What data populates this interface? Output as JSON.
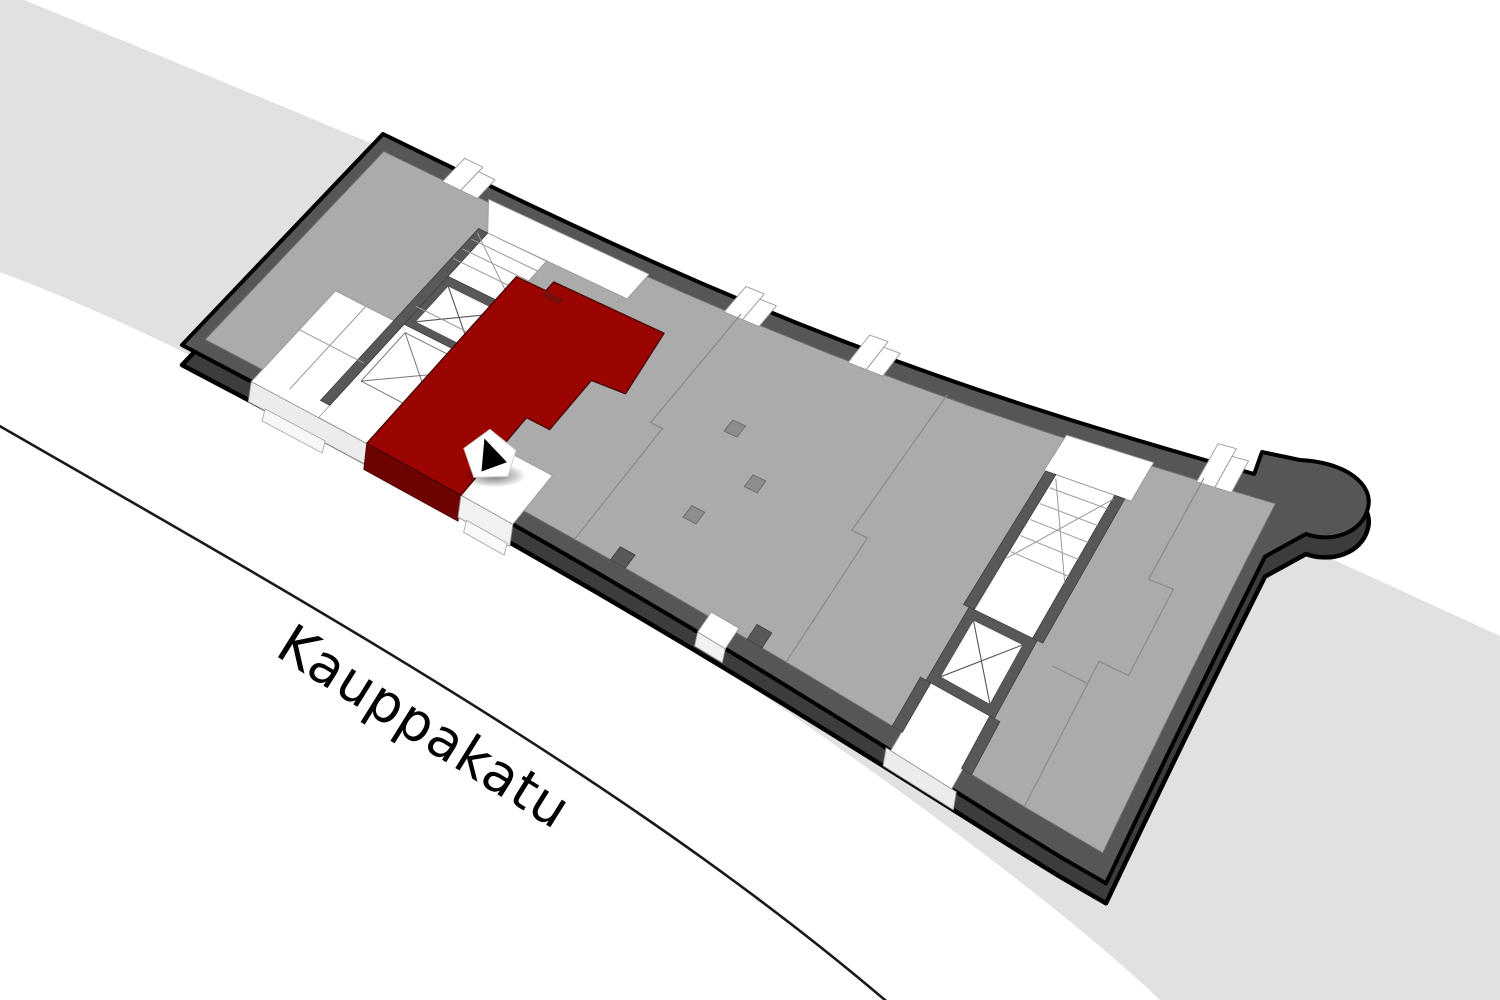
{
  "page": {
    "width": 1500,
    "height": 1000,
    "background": "#ffffff"
  },
  "street": {
    "label": "Kauppakatu",
    "angle_deg": 32,
    "band_color": "#e1e1e1",
    "curb_color": "#1a1a1a",
    "band_path": "M 24,0 C 500,195 1000,405 1500,636 L 1500,1000 L 1160,1000 C 1005,850 420,430 0,272 L 0,0 Z",
    "curb_path": "M -4,424 C 320,610 640,790 892,1006"
  },
  "marker": {
    "u": 0.3,
    "v": 0.84,
    "base_color": "#ffffff",
    "arrow_color": "#000000"
  },
  "building": {
    "corners": {
      "N": [
        383,
        134
      ],
      "E": [
        1300,
        487
      ],
      "S": [
        1045,
        848
      ],
      "W": [
        121,
        313
      ]
    },
    "shear": 0.066,
    "sag_top": 30,
    "sag_front": -16,
    "base_drop": 20,
    "colors": {
      "wall_top": "#565656",
      "wall_side": "#3c3c3c",
      "outline": "#000000",
      "floor": "#ababab",
      "floor_line": "#6e6e6e",
      "white": "#ffffff",
      "white_edge": "#9a9a9a",
      "divider": "#8a8a8a",
      "shaft": "#585858",
      "column": "#8d8d8d",
      "column_edge": "#6e6e6e",
      "unit_red": "#9a0502",
      "unit_red_front": "#6d0401",
      "unit_red_dark": "#7c0e0a",
      "unit_red_edge": "#4d0300"
    },
    "bulge": {
      "after_u": 0.95,
      "pts_line": [
        [
          1262,
          452
        ],
        [
          1300,
          460
        ]
      ],
      "bez": [
        [
          1345,
          462
        ],
        [
          1374,
          484
        ],
        [
          1368,
          508
        ],
        [
          1362,
          534
        ],
        [
          1330,
          543
        ],
        [
          1306,
          534
        ]
      ],
      "resume_v": 0.18
    },
    "floor_inset": {
      "u0": 0.013,
      "u1": 0.985,
      "v0": 0.055,
      "v1": 0.945
    },
    "white_areas": [
      {
        "id": "sw-rooms-block",
        "pts": [
          [
            0.075,
            0.58
          ],
          [
            0.145,
            0.58
          ],
          [
            0.145,
            0.42
          ],
          [
            0.215,
            0.42
          ],
          [
            0.215,
            1.0
          ],
          [
            0.075,
            1.0
          ]
        ]
      },
      {
        "id": "corridor-west-top",
        "pts": [
          [
            0.125,
            0.045
          ],
          [
            0.3,
            0.045
          ],
          [
            0.3,
            0.155
          ],
          [
            0.148,
            0.155
          ]
        ]
      },
      {
        "id": "corridor-west",
        "pts": [
          [
            0.148,
            0.155
          ],
          [
            0.212,
            0.155
          ],
          [
            0.212,
            1.0
          ],
          [
            0.148,
            1.0
          ]
        ]
      },
      {
        "id": "corridor-east-top",
        "pts": [
          [
            0.755,
            0.045
          ],
          [
            0.85,
            0.045
          ],
          [
            0.85,
            0.16
          ],
          [
            0.755,
            0.16
          ]
        ]
      },
      {
        "id": "corridor-east",
        "pts": [
          [
            0.767,
            0.16
          ],
          [
            0.833,
            0.16
          ],
          [
            0.833,
            1.0
          ],
          [
            0.767,
            1.0
          ]
        ]
      },
      {
        "id": "entrance-landing",
        "pts": [
          [
            0.302,
            0.8
          ],
          [
            0.358,
            0.8
          ],
          [
            0.358,
            1.0
          ],
          [
            0.302,
            1.0
          ]
        ]
      },
      {
        "id": "front-door-mid",
        "pts": [
          [
            0.558,
            0.93
          ],
          [
            0.588,
            0.93
          ],
          [
            0.588,
            1.0
          ],
          [
            0.558,
            1.0
          ]
        ]
      }
    ],
    "north_tabs": [
      0.078,
      0.385,
      0.52,
      0.9
    ],
    "shaft_walls": [
      {
        "id": "elevator-west-shaft",
        "pts": [
          [
            0.143,
            0.355
          ],
          [
            0.227,
            0.355
          ],
          [
            0.227,
            0.575
          ],
          [
            0.143,
            0.575
          ]
        ]
      },
      {
        "id": "corridor-west-wall",
        "pts": [
          [
            0.138,
            0.155
          ],
          [
            0.148,
            0.155
          ],
          [
            0.148,
            0.945
          ],
          [
            0.138,
            0.945
          ]
        ]
      },
      {
        "id": "corridor-east-wall-a",
        "pts": [
          [
            0.757,
            0.16
          ],
          [
            0.768,
            0.16
          ],
          [
            0.768,
            0.58
          ],
          [
            0.757,
            0.58
          ]
        ]
      },
      {
        "id": "corridor-east-wall-b",
        "pts": [
          [
            0.832,
            0.16
          ],
          [
            0.843,
            0.16
          ],
          [
            0.843,
            0.58
          ],
          [
            0.832,
            0.58
          ]
        ]
      },
      {
        "id": "corridor-east-wall-c",
        "pts": [
          [
            0.757,
            0.8
          ],
          [
            0.768,
            0.8
          ],
          [
            0.768,
            0.945
          ],
          [
            0.757,
            0.945
          ]
        ]
      },
      {
        "id": "corridor-east-wall-d",
        "pts": [
          [
            0.832,
            0.8
          ],
          [
            0.843,
            0.8
          ],
          [
            0.843,
            0.945
          ],
          [
            0.832,
            0.945
          ]
        ]
      },
      {
        "id": "elevator-east-shaft",
        "pts": [
          [
            0.763,
            0.58
          ],
          [
            0.837,
            0.58
          ],
          [
            0.837,
            0.8
          ],
          [
            0.763,
            0.8
          ]
        ]
      },
      {
        "id": "front-wall-stub-a",
        "pts": [
          [
            0.452,
            0.895
          ],
          [
            0.468,
            0.895
          ],
          [
            0.468,
            0.945
          ],
          [
            0.452,
            0.945
          ]
        ]
      },
      {
        "id": "front-wall-stub-b",
        "pts": [
          [
            0.6,
            0.895
          ],
          [
            0.616,
            0.895
          ],
          [
            0.616,
            0.945
          ],
          [
            0.6,
            0.945
          ]
        ]
      }
    ],
    "elevators": [
      {
        "id": "elevator-west",
        "pts": [
          [
            0.155,
            0.385
          ],
          [
            0.215,
            0.385
          ],
          [
            0.215,
            0.55
          ],
          [
            0.155,
            0.55
          ]
        ]
      },
      {
        "id": "elevator-east",
        "pts": [
          [
            0.773,
            0.605
          ],
          [
            0.827,
            0.605
          ],
          [
            0.827,
            0.775
          ],
          [
            0.773,
            0.775
          ]
        ]
      }
    ],
    "stair_boxes": [
      {
        "id": "stairs-sw-box",
        "pts": [
          [
            0.155,
            0.6
          ],
          [
            0.235,
            0.6
          ],
          [
            0.235,
            0.82
          ],
          [
            0.155,
            0.82
          ]
        ],
        "cross": true
      }
    ],
    "stair_lines": [
      {
        "id": "stairs-west-treads",
        "lines": [
          [
            [
              0.14,
              0.2
            ],
            [
              0.212,
              0.2
            ]
          ],
          [
            [
              0.14,
              0.245
            ],
            [
              0.212,
              0.245
            ]
          ],
          [
            [
              0.14,
              0.29
            ],
            [
              0.212,
              0.29
            ]
          ],
          [
            [
              0.14,
              0.17
            ],
            [
              0.212,
              0.335
            ]
          ]
        ]
      },
      {
        "id": "stairs-sw-treads",
        "lines": [
          [
            [
              0.235,
              0.64
            ],
            [
              0.26,
              0.64
            ]
          ],
          [
            [
              0.235,
              0.68
            ],
            [
              0.26,
              0.68
            ]
          ],
          [
            [
              0.235,
              0.72
            ],
            [
              0.26,
              0.72
            ]
          ],
          [
            [
              0.235,
              0.76
            ],
            [
              0.26,
              0.76
            ]
          ],
          [
            [
              0.235,
              0.8
            ],
            [
              0.26,
              0.8
            ]
          ]
        ]
      },
      {
        "id": "sw-room-lines",
        "lines": [
          [
            [
              0.108,
              0.58
            ],
            [
              0.108,
              0.96
            ]
          ],
          [
            [
              0.075,
              0.76
            ],
            [
              0.145,
              0.76
            ]
          ],
          [
            [
              0.145,
              0.5
            ],
            [
              0.215,
              0.5
            ]
          ]
        ]
      },
      {
        "id": "stairs-east-treads",
        "lines": [
          [
            [
              0.77,
              0.2
            ],
            [
              0.833,
              0.2
            ]
          ],
          [
            [
              0.77,
              0.25
            ],
            [
              0.833,
              0.25
            ]
          ],
          [
            [
              0.77,
              0.3
            ],
            [
              0.833,
              0.3
            ]
          ],
          [
            [
              0.77,
              0.35
            ],
            [
              0.833,
              0.35
            ]
          ],
          [
            [
              0.77,
              0.4
            ],
            [
              0.833,
              0.4
            ]
          ],
          [
            [
              0.77,
              0.17
            ],
            [
              0.833,
              0.42
            ]
          ],
          [
            [
              0.833,
              0.17
            ],
            [
              0.77,
              0.42
            ]
          ]
        ]
      }
    ],
    "dividers": [
      {
        "id": "room-divider-1",
        "pts": [
          [
            0.4,
            0.045
          ],
          [
            0.4,
            0.5
          ],
          [
            0.413,
            0.5
          ],
          [
            0.413,
            0.945
          ]
        ]
      },
      {
        "id": "room-divider-2",
        "pts": [
          [
            0.625,
            0.045
          ],
          [
            0.625,
            0.53
          ],
          [
            0.642,
            0.53
          ],
          [
            0.642,
            0.945
          ]
        ]
      },
      {
        "id": "room-divider-3",
        "pts": [
          [
            0.905,
            0.045
          ],
          [
            0.905,
            0.33
          ],
          [
            0.932,
            0.33
          ],
          [
            0.932,
            0.56
          ],
          [
            0.9,
            0.56
          ],
          [
            0.9,
            0.945
          ]
        ]
      },
      {
        "id": "room-divider-4",
        "pts": [
          [
            0.862,
            0.62
          ],
          [
            0.9,
            0.62
          ]
        ]
      }
    ],
    "columns": [
      [
        0.47,
        0.4
      ],
      [
        0.52,
        0.53
      ],
      [
        0.49,
        0.7
      ]
    ],
    "highlight_unit": {
      "id": "highlighted-unit",
      "pts": [
        [
          0.2,
          0.25
        ],
        [
          0.232,
          0.25
        ],
        [
          0.232,
          0.21
        ],
        [
          0.352,
          0.21
        ],
        [
          0.362,
          0.45
        ],
        [
          0.327,
          0.46
        ],
        [
          0.327,
          0.67
        ],
        [
          0.302,
          0.67
        ],
        [
          0.302,
          1.0
        ],
        [
          0.2,
          1.0
        ]
      ],
      "accent_pts": [
        [
          0.232,
          0.25
        ],
        [
          0.252,
          0.25
        ],
        [
          0.252,
          0.275
        ],
        [
          0.232,
          0.275
        ]
      ]
    },
    "front_faces": [
      {
        "id": "front-face-sw-white",
        "u0": 0.075,
        "u1": 0.213,
        "y0": 0,
        "y1": 20,
        "fill": "#ececec",
        "stroke": "#9a9a9a"
      },
      {
        "id": "front-face-sw-step",
        "u0": 0.09,
        "u1": 0.155,
        "y0": 20,
        "y1": 32,
        "fill": "#f7f7f7",
        "stroke": "#aaaaaa"
      },
      {
        "id": "front-face-unit-red",
        "u0": 0.2,
        "u1": 0.302,
        "y0": 0,
        "y1": 26,
        "fill": "#6d0401",
        "stroke": "#4d0300"
      },
      {
        "id": "front-face-entrance",
        "u0": 0.302,
        "u1": 0.358,
        "y0": 0,
        "y1": 22,
        "fill": "#f1f1f1",
        "stroke": "#9a9a9a"
      },
      {
        "id": "front-face-entry-step",
        "u0": 0.308,
        "u1": 0.352,
        "y0": 22,
        "y1": 34,
        "fill": "#fafafa",
        "stroke": "#aaaaaa"
      },
      {
        "id": "front-face-door-mid",
        "u0": 0.558,
        "u1": 0.588,
        "y0": 0,
        "y1": 14,
        "fill": "#f1f1f1",
        "stroke": "#9a9a9a"
      },
      {
        "id": "front-face-corridor-e",
        "u0": 0.762,
        "u1": 0.838,
        "y0": 0,
        "y1": 18,
        "fill": "#ececec",
        "stroke": "#9a9a9a"
      }
    ]
  }
}
